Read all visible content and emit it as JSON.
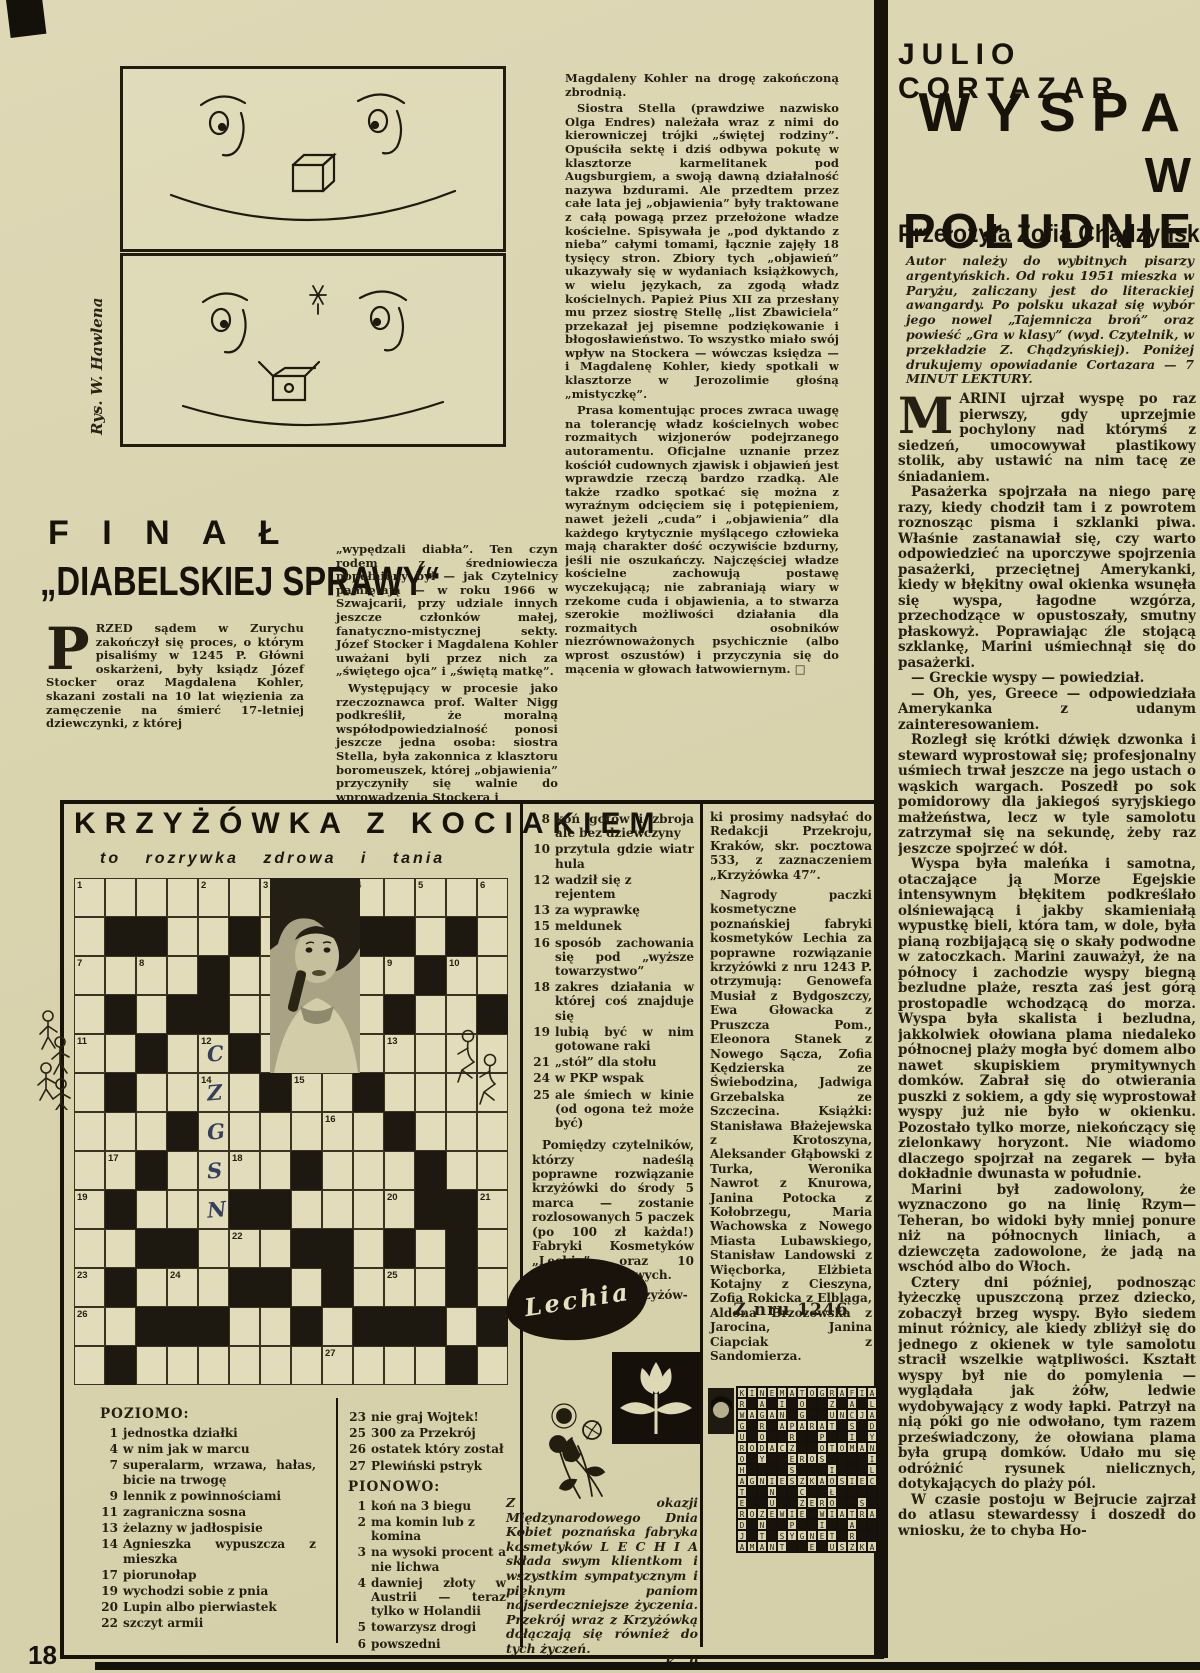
{
  "page": {
    "number": "18"
  },
  "colors": {
    "paper": "#dcd6b2",
    "ink": "#241f12",
    "pencil": "#33405e"
  },
  "cartoon": {
    "credit": "Rys. W. Hawlena"
  },
  "final": {
    "title_line1": "F I N A Ł",
    "title_line2": "„DIABELSKIEJ SPRAWY“",
    "dropcap": "P",
    "col1": "RZED sądem w Zurychu zakończył się proces, o którym pisaliśmy w 1245 P. Główni oskarżeni, były ksiądz Józef Stocker oraz Magdalena Kohler, skazani zostali na 10 lat więzienia za zamęczenie na śmierć 17-letniej dziewczynki, z której",
    "col2": [
      "„wypędzali diabła”. Ten czyn rodem z średniowiecza popełniony był — jak Czytelnicy pamiętają — w roku 1966 w Szwajcarii, przy udziale innych jeszcze członków małej, fanatyczno-mistycznej sekty. Józef Stocker i Magdalena Kohler uważani byli przez nich za „świętego ojca” i „świętą matkę”.",
      "Występujący w procesie jako rzeczoznawca prof. Walter Nigg podkreślił, że moralną współodpowiedzialność ponosi jeszcze jedna osoba: siostra Stella, była zakonnica z klasztoru boromeuszek, której „objawienia” przyczyniły się walnie do wprowadzenia Stockera i"
    ],
    "col3": [
      "Magdaleny Kohler na drogę zakończoną zbrodnią.",
      "Siostra Stella (prawdziwe nazwisko Olga Endres) należała wraz z nimi do kierowniczej trójki „świętej rodziny”. Opuściła sektę i dziś odbywa pokutę w klasztorze karmelitanek pod Augsburgiem, a swoją dawną działalność nazywa bzdurami. Ale przedtem przez całe lata jej „objawienia” były traktowane z całą powagą przez przełożone władze kościelne. Spisywała je „pod dyktando z nieba” całymi tomami, łącznie zajęły 18 tysięcy stron. Zbiory tych „objawień” ukazywały się w wydaniach książkowych, w wielu językach, za zgodą władz kościelnych. Papież Pius XII za przesłany mu przez siostrę Stellę „list Zbawiciela” przekazał jej pisemne podziękowanie i błogosławieństwo. To wszystko miało swój wpływ na Stockera — wówczas księdza — i Magdalenę Kohler, kiedy spotkali w klasztorze w Jerozolimie głośną „mistyczkę”.",
      "Prasa komentując proces zwraca uwagę na tolerancję władz kościelnych wobec rozmaitych wizjonerów podejrzanego autoramentu. Oficjalne uznanie przez kościół cudownych zjawisk i objawień jest wprawdzie rzeczą bardzo rzadką. Ale także rzadko spotkać się można z wyraźnym odcięciem się i potępieniem, nawet jeżeli „cuda” i „objawienia” dla każdego krytycznie myślącego człowieka mają charakter dość oczywiście bzdurny, jeśli nie oszukańczy. Najczęściej władze kościelne zachowują postawę wyczekującą; nie zabraniają wiary w rzekome cuda i objawienia, a to stwarza szerokie możliwości działania dla rozmaitych osobników niezrównoważonych psychicznie (albo wprost oszustów) i przyczynia się do mącenia w głowach łatwowiernym.  □"
    ]
  },
  "cortazar": {
    "author": "JULIO CORTAZAR",
    "title_line1": "WYSPA",
    "title_line2": "W POŁUDNIE",
    "translator": "Przełożyła Zofia Chądzyńska",
    "intro": "Autor należy do wybitnych pisarzy argentyńskich. Od roku 1951 mieszka w Paryżu, zaliczany jest do literackiej awangardy. Po polsku ukazał się wybór jego nowel „Tajemnicza broń” oraz powieść „Gra w klasy” (wyd. Czytelnik, w przekładzie Z. Chądzyńskiej). Poniżej drukujemy opowiadanie Cortazara — 7 MINUT LEKTURY.",
    "dropcap": "M",
    "paras": [
      "ARINI ujrzał wyspę po raz pierwszy, gdy uprzejmie pochylony nad którymś z siedzeń, umocowywał plastikowy stolik, aby ustawić na nim tacę ze śniadaniem.",
      "Pasażerka spojrzała na niego parę razy, kiedy chodził tam i z powrotem roznosząc pisma i szklanki piwa. Właśnie zastanawiał się, czy warto odpowiedzieć na uporczywe spojrzenia pasażerki, przeciętnej Amerykanki, kiedy w błękitny owal okienka wsunęła się wyspa, łagodne wzgórza, przechodzące w opustoszały, smutny płaskowyż. Poprawiając źle stojącą szklankę, Marini uśmiechnął się do pasażerki.",
      "— Greckie wyspy — powiedział.",
      "— Oh, yes, Greece — odpowiedziała Amerykanka z udanym zainteresowaniem.",
      "Rozległ się krótki dźwięk dzwonka i steward wyprostował się; profesjonalny uśmiech trwał jeszcze na jego ustach o wąskich wargach. Poszedł po sok pomidorowy dla jakiegoś syryjskiego małżeństwa, lecz w tyle samolotu zatrzymał się na sekundę, żeby raz jeszcze spojrzeć w dół.",
      "Wyspa była maleńka i samotna, otaczające ją Morze Egejskie intensywnym błękitem podkreślało olśniewającą i jakby skamieniałą wypustkę bieli, która tam, w dole, była pianą rozbijającą się o skały podwodne w zatoczkach. Marini zauważył, że na północy i zachodzie wyspy biegną bezludne plaże, reszta zaś jest górą prostopadle wchodzącą do morza. Wyspa była skalista i bezludna, jakkolwiek ołowiana plama niedaleko północnej plaży mogła być domem albo nawet skupiskiem prymitywnych domków. Zabrał się do otwierania puszki z sokiem, a gdy się wyprostował wyspy już nie było w okienku. Pozostało tylko morze, niekończący się zielonkawy horyzont. Nie wiadomo dlaczego spojrzał na zegarek — była dokładnie dwunasta w południe.",
      "Marini był zadowolony, że wyznaczono go na linię Rzym—Teheran, bo widoki były mniej ponure niż na północnych liniach, a dziewczęta zadowolone, że jadą na wschód albo do Włoch.",
      "Cztery dni później, podnosząc łyżeczkę upuszczoną przez dziecko, zobaczył brzeg wyspy. Było siedem minut różnicy, ale kiedy zbliżył się do jednego z okienek w tyle samolotu stracił wszelkie wątpliwości. Kształt wyspy był nie do pomylenia — wyglądała jak żółw, ledwie wydobywający z wody łapki. Patrzył na nią póki go nie odwołano, tym razem przeświadczony, że ołowiana plama była grupą domków. Udało mu się odróżnić rysunek nielicznych, dotykających do plaży pól.",
      "W czasie postoju w Bejrucie zajrzał do atlasu stewardessy i doszedł do wniosku, że to chyba Ho-"
    ]
  },
  "crossword": {
    "title": "KRZYŻÓWKA Z KOCIAKIEM",
    "subtitle": "to rozrywka zdrowa i tania",
    "grid_rows": [
      [
        "1",
        "",
        "",
        "",
        "2",
        "",
        "3",
        "",
        "",
        "4",
        "",
        "5",
        "",
        "6"
      ],
      [
        "",
        "#",
        "#",
        "",
        "",
        "#",
        "",
        "",
        "",
        "#",
        "#",
        "",
        "#",
        ""
      ],
      [
        "7",
        "",
        "8",
        "",
        "#",
        "",
        "",
        "",
        "",
        "",
        "9",
        "#",
        "10",
        ""
      ],
      [
        "",
        "#",
        "",
        "#",
        "#",
        "",
        "",
        "",
        "#",
        "",
        "#",
        "",
        "",
        "#"
      ],
      [
        "11",
        "",
        "#",
        "",
        "12*C",
        "#",
        "",
        "",
        "",
        "",
        "13",
        "",
        "",
        ""
      ],
      [
        "",
        "#",
        "",
        "",
        "14*Z",
        "",
        "#",
        "15",
        "",
        "#",
        "",
        "",
        "",
        ""
      ],
      [
        "",
        "",
        "",
        "#",
        "*G",
        "",
        "",
        "",
        "16",
        "",
        "#",
        "",
        "",
        ""
      ],
      [
        "",
        "17",
        "#",
        "",
        "*S",
        "18",
        "",
        "#",
        "",
        "",
        "",
        "#",
        "",
        ""
      ],
      [
        "19",
        "#",
        "",
        "",
        "*N",
        "#",
        "#",
        "",
        "",
        "",
        "20",
        "#",
        "#",
        "21"
      ],
      [
        "",
        "",
        "#",
        "#",
        "",
        "22",
        "",
        "#",
        "#",
        "",
        "#",
        "",
        "#",
        ""
      ],
      [
        "23",
        "#",
        "",
        "24",
        "",
        "#",
        "#",
        "",
        "#",
        "",
        "25",
        "",
        "#",
        ""
      ],
      [
        "26",
        "",
        "#",
        "#",
        "#",
        "",
        "",
        "#",
        "",
        "#",
        "#",
        "#",
        "",
        "#"
      ],
      [
        "",
        "#",
        "",
        "",
        "",
        "",
        "",
        "",
        "27",
        "",
        "",
        "",
        "#",
        ""
      ]
    ],
    "clues_mid": [
      {
        "n": "8",
        "t": "koń gotów i zbroja ale bez dziewczyny"
      },
      {
        "n": "10",
        "t": "przytula gdzie wiatr hula"
      },
      {
        "n": "12",
        "t": "wadził się z rejentem"
      },
      {
        "n": "13",
        "t": "za wyprawkę"
      },
      {
        "n": "15",
        "t": "meldunek"
      },
      {
        "n": "16",
        "t": "sposób zachowania się pod „wyższe towarzystwo”"
      },
      {
        "n": "18",
        "t": "zakres działania w której coś znajduje się"
      },
      {
        "n": "19",
        "t": "lubią być w nim gotowane raki"
      },
      {
        "n": "21",
        "t": "„stół” dla stołu"
      },
      {
        "n": "24",
        "t": "w PKP wspak"
      },
      {
        "n": "25",
        "t": "ale śmiech w kinie (od ogona też może być)"
      }
    ],
    "draw_note": "Pomiędzy czytelników, którzy nadeślą poprawne rozwiązanie krzyżówki do środy 5 marca — zostanie rozlosowanych 5 paczek (po 100 zł każda!) Fabryki Kosmetyków „Lechia” oraz 10 nagród książkowych.",
    "rozw": "Rozwiązanie krzyżów-",
    "poziomo_label": "POZIOMO:",
    "poziomo": [
      {
        "n": "1",
        "t": "jednostka działki"
      },
      {
        "n": "4",
        "t": "w nim jak w marcu"
      },
      {
        "n": "7",
        "t": "superalarm, wrzawa, hałas, bicie na trwogę"
      },
      {
        "n": "9",
        "t": "lennik z powinnościami"
      },
      {
        "n": "11",
        "t": "zagraniczna sosna"
      },
      {
        "n": "13",
        "t": "żelazny w jadłospisie"
      },
      {
        "n": "14",
        "t": "Agnieszka wypuszcza z mieszka"
      },
      {
        "n": "17",
        "t": "piorunołap"
      },
      {
        "n": "19",
        "t": "wychodzi sobie z pnia"
      },
      {
        "n": "20",
        "t": "Lupin albo pierwiastek"
      },
      {
        "n": "22",
        "t": "szczyt armii"
      }
    ],
    "poziomo_tail": [
      {
        "n": "23",
        "t": "nie graj Wojtek!"
      },
      {
        "n": "25",
        "t": "300 za Przekrój"
      },
      {
        "n": "26",
        "t": "ostatek który został"
      },
      {
        "n": "27",
        "t": "Plewiński pstryk"
      }
    ],
    "pionowo_label": "PIONOWO:",
    "pionowo": [
      {
        "n": "1",
        "t": "koń na 3 biegu"
      },
      {
        "n": "2",
        "t": "ma komin lub z komina"
      },
      {
        "n": "3",
        "t": "na wysoki procent a nie lichwa"
      },
      {
        "n": "4",
        "t": "dawniej złoty w Austrii — teraz tylko w Holandii"
      },
      {
        "n": "5",
        "t": "towarzysz drogi"
      },
      {
        "n": "6",
        "t": "powszedni"
      }
    ],
    "submit_text": "ki prosimy nadsyłać do Redakcji Przekroju, Kraków, skr. pocztowa 533, z zaznaczeniem „Krzyżówka 47”.",
    "prizes_text": "Nagrody paczki kosmetyczne poznańskiej fabryki kosmetyków Lechia za poprawne rozwiązanie krzyżówki z nru 1243 P. otrzymują: Genowefa Musiał z Bydgoszczy, Ewa Głowacka z Pruszcza Pom., Eleonora Stanek z Nowego Sącza, Zofia Kędzierska ze Świebodzina, Jadwiga Grzebalska ze Szczecina. Książki: Stanisława Błażejewska z Krotoszyna, Aleksander Głąbowski z Turka, Weronika Nawrot z Knurowa, Janina Potocka z Kołobrzegu, Maria Wachowska z Nowego Miasta Lubawskiego, Stanisław Landowski z Więcborka, Elżbieta Kotajny z Cieszyna, Zofia Rokicka z Elbląga, Aldona Brzozowska z Jarocina, Janina Ciapciak z Sandomierza.",
    "solution_label": "Z nru 1246",
    "solution_rows": [
      "KINEMATOGRAFIA",
      "R A I O  Z A L",
      "WAGAN G  UNCJA",
      "G R APARAT S D",
      "U O  R  P  I Y",
      "RODACZ  OTOMAN",
      "O Y  EROS    I",
      "H    S   I   L",
      "AGNIESZKAOSIEC",
      "T  N  C  Ł    ",
      "E  U  ZERO  S ",
      "ROZEWIE WIATRA",
      "D N  P  I  A  ",
      "J T SYGNET R  ",
      "AMANT  E USZKA"
    ],
    "lechia_logo_text": "Lechia",
    "note": "Z okazji Międzynarodowego Dnia Kobiet poznańska fabryka kosmetyków L E C H I A składa swym klientkom i wszystkim sympatycznym i pięknym paniom najserdeczniejsze życzenia. Przekrój wraz z Krzyżówką dołączają się również do tych życzeń.",
    "signature": "K—9"
  }
}
